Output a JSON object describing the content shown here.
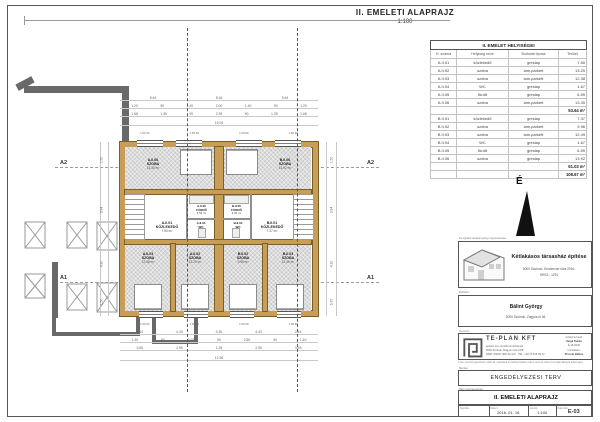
{
  "title": {
    "text": "II. EMELETI ALAPRAJZ",
    "scale": "1:100"
  },
  "north_label": "É",
  "axes": {
    "a2": "A2",
    "a1": "A1"
  },
  "room_table": {
    "title": "II. EMELET HELYISÉGEI",
    "headers": [
      "H. száma",
      "Helyiség neve",
      "Burkolat típusa",
      "Terület"
    ],
    "rows_a": [
      {
        "num": "A.II.01",
        "name": "közlekedő",
        "floor": "greslap",
        "area": "7.50"
      },
      {
        "num": "A.II.02",
        "name": "szoba",
        "floor": "lam.parkett",
        "area": "13.20"
      },
      {
        "num": "A.II.03",
        "name": "szoba",
        "floor": "lam.parkett",
        "area": "12.38"
      },
      {
        "num": "A.II.04",
        "name": "WC",
        "floor": "greslap",
        "area": "1.67"
      },
      {
        "num": "A.II.05",
        "name": "fürdő",
        "floor": "greslap",
        "area": "6.59"
      },
      {
        "num": "A.II.06",
        "name": "szoba",
        "floor": "lam.parkett",
        "area": "13.30"
      }
    ],
    "subtotal_a": "53.64 m²",
    "rows_b": [
      {
        "num": "B.II.01",
        "name": "közlekedő",
        "floor": "greslap",
        "area": "7.37"
      },
      {
        "num": "B.II.02",
        "name": "szoba",
        "floor": "lam.parkett",
        "area": "9.96"
      },
      {
        "num": "B.II.03",
        "name": "szoba",
        "floor": "lam.parkett",
        "area": "12.49"
      },
      {
        "num": "B.II.04",
        "name": "WC",
        "floor": "greslap",
        "area": "1.67"
      },
      {
        "num": "B.II.05",
        "name": "fürdő",
        "floor": "greslap",
        "area": "6.59"
      },
      {
        "num": "B.II.06",
        "name": "szoba",
        "floor": "greslap",
        "area": "13.92"
      }
    ],
    "subtotal_b": "61.03 m²",
    "total": "108.67 m²"
  },
  "plan": {
    "rooms": [
      {
        "id": "A.II.06",
        "name": "SZOBA",
        "area": "13.30 m²"
      },
      {
        "id": "B.II.06",
        "name": "SZOBA",
        "area": "13.92 m²"
      },
      {
        "id": "A.II.05",
        "name": "FÜRDŐ",
        "area": "6.59 m²"
      },
      {
        "id": "B.II.05",
        "name": "FÜRDŐ",
        "area": "6.59 m²"
      },
      {
        "id": "A.II.04",
        "name": "WC",
        "area": "1.67 m²"
      },
      {
        "id": "B.II.04",
        "name": "WC",
        "area": "1.67 m²"
      },
      {
        "id": "A.II.01",
        "name": "KÖZLEKEDŐ",
        "area": "7.50 m²"
      },
      {
        "id": "B.II.01",
        "name": "KÖZLEKEDŐ",
        "area": "7.37 m²"
      },
      {
        "id": "A.II.03",
        "name": "SZOBA",
        "area": "12.38 m²"
      },
      {
        "id": "A.II.02",
        "name": "SZOBA",
        "area": "13.20 m²"
      },
      {
        "id": "B.II.02",
        "name": "SZOBA",
        "area": "9.96 m²"
      },
      {
        "id": "B.II.03",
        "name": "SZOBA",
        "area": "12.49 m²"
      }
    ],
    "dims_top1": [
      "5.44",
      "8.16",
      "5.44"
    ],
    "dims_top2": [
      "1.20",
      "90",
      "1.40",
      "2.00",
      "1.40",
      "90",
      "1.20"
    ],
    "dims_top3": [
      "1.68",
      "1.35",
      "90",
      "2.35",
      "90",
      "1.35",
      "1.68"
    ],
    "total_top": "19.04",
    "win_top": [
      "1.50 90",
      "1.50 90",
      "1.50 90",
      "1.50 90"
    ],
    "win_bottom": [
      "1.50 90",
      "1.50 90",
      "1.50 90",
      "1.50 90"
    ],
    "dims_bottom1": [
      "2.44",
      "4.43",
      "3.30",
      "4.43",
      "2.44"
    ],
    "dims_bottom2": [
      "1.40",
      "90",
      "3.00",
      "90",
      "2.80",
      "90",
      "1.40"
    ],
    "dims_bottom3": [
      "3.65",
      "2.96",
      "1.28",
      "2.96",
      "3.65"
    ],
    "total_bottom": "12.56",
    "dims_left": [
      "1.50",
      "3.94",
      "4.30",
      "1.50"
    ],
    "dims_right": [
      "1.50",
      "3.94",
      "4.30",
      "6.70"
    ]
  },
  "titleblock": {
    "label_project": "Az építési tevékenység megnevezése:",
    "project_title": "Kétlakásos társasház építése",
    "project_addr1": "5000 Szolnok, Kendervári utca 2016.",
    "project_addr2": "HRSZ.: 1291",
    "label_client": "Építtető:",
    "client_name": "Bálint György",
    "client_addr": "5000 Szolnok, Zagyva út 46.",
    "label_designer": "Tervező:",
    "company": "TE-PLAN KFT",
    "company_line1": "építész és mérnöki tervezőiroda",
    "company_line2": "5000 Szolnok, Magyar utca 21/B",
    "company_line3": "WEB: WWW.TEPLAN.HU  ·  TEL: +36 70 518 99 62",
    "designer_role": "vezető tervező:",
    "designer_name": "Varga Tamás",
    "designer_id": "É 16-0030",
    "assistant_role": "munkatárs:",
    "assistant_name": "Prozsár Balázs",
    "legal": "A terv szerzői jogvédelem alatt áll, másolása és felhasználása csak a tervező írásos hozzájárulásával lehetséges.",
    "label_phase": "Munka:",
    "phase": "ENGEDÉLYEZÉSI TERV",
    "label_drawing": "Rajz megnevezése:",
    "drawing": "II. EMELETI ALAPRAJZ",
    "bottom": {
      "label1": "Rajzolta:",
      "val1": "",
      "label2": "Dátum:",
      "val2": "2016. 01. 16.",
      "label3": "Lépték:",
      "val3": "1:100",
      "label4": "Rajzszám:",
      "val4": "E-03"
    }
  }
}
